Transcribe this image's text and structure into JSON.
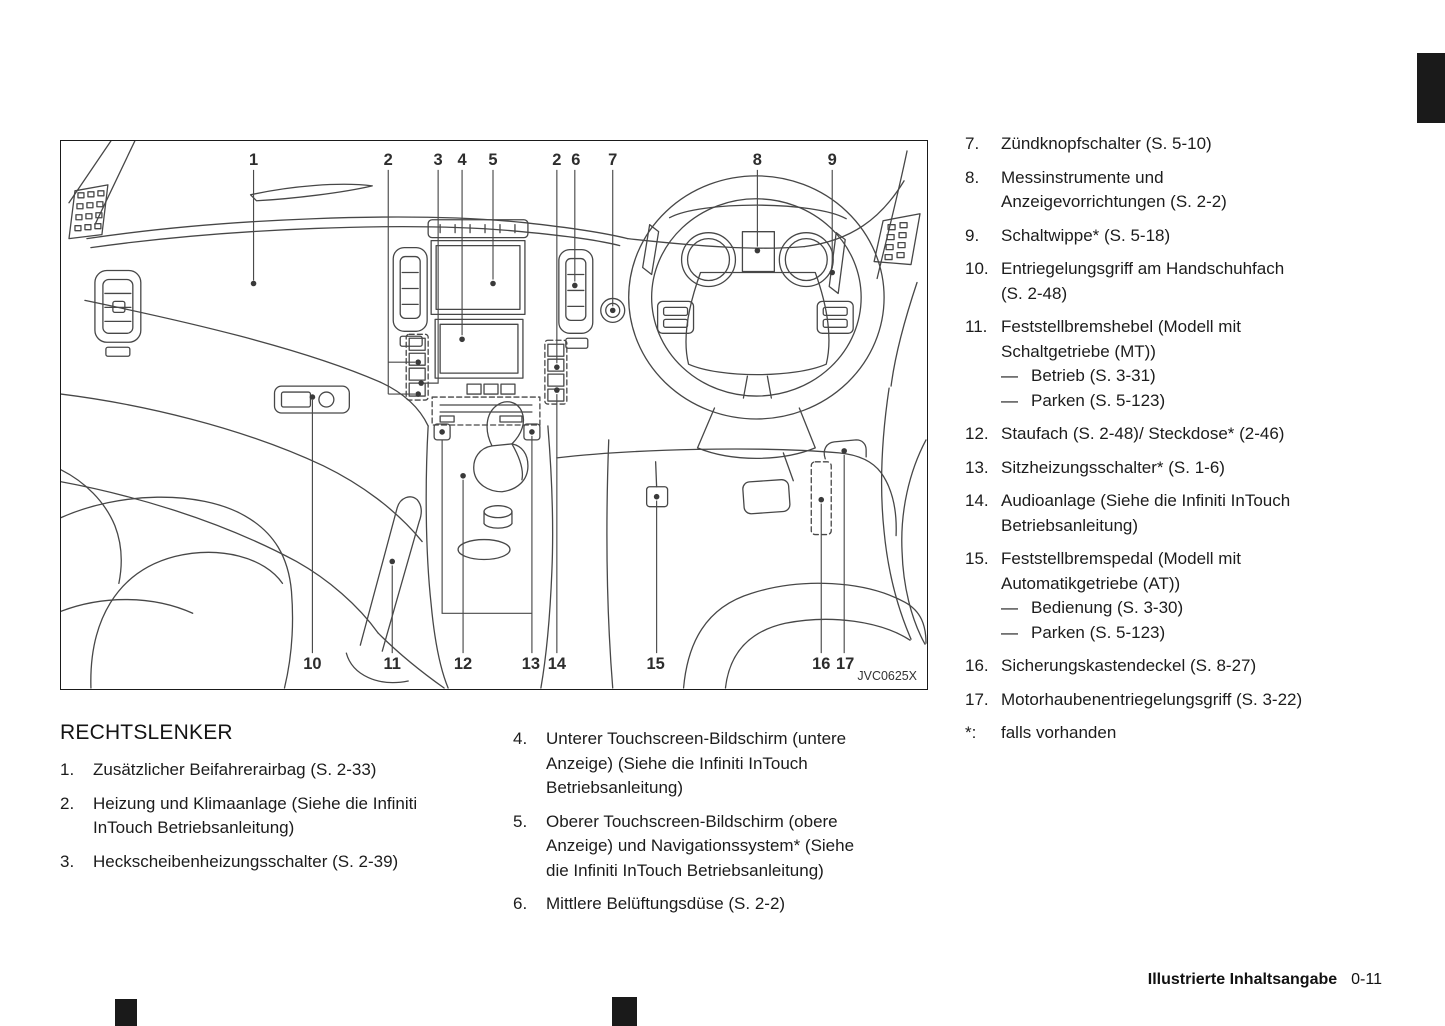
{
  "colors": {
    "background": "#ffffff",
    "ink": "#1c1c1c",
    "diagram_line": "#474747",
    "tab_marker": "#1a1a1a"
  },
  "figure": {
    "code": "JVC0625X",
    "callouts_top": [
      "1",
      "2",
      "3",
      "4",
      "5",
      "2",
      "6",
      "7",
      "8",
      "9"
    ],
    "callouts_bottom": [
      "10",
      "11",
      "12",
      "13",
      "14",
      "15",
      "16",
      "17"
    ]
  },
  "legend": {
    "heading": "RECHTSLENKER",
    "dash": "—",
    "col1": [
      {
        "num": "1.",
        "lines": [
          "Zusätzlicher Beifahrerairbag (S. 2-33)"
        ]
      },
      {
        "num": "2.",
        "lines": [
          "Heizung und Klimaanlage (Siehe die Infiniti",
          "InTouch Betriebsanleitung)"
        ]
      },
      {
        "num": "3.",
        "lines": [
          "Heckscheibenheizungsschalter (S. 2-39)"
        ]
      }
    ],
    "col2": [
      {
        "num": "4.",
        "lines": [
          "Unterer Touchscreen-Bildschirm (untere",
          "Anzeige) (Siehe die Infiniti InTouch",
          "Betriebsanleitung)"
        ]
      },
      {
        "num": "5.",
        "lines": [
          "Oberer Touchscreen-Bildschirm (obere",
          "Anzeige) und Navigationssystem* (Siehe",
          "die Infiniti InTouch Betriebsanleitung)"
        ]
      },
      {
        "num": "6.",
        "lines": [
          "Mittlere Belüftungsdüse (S. 2-2)"
        ]
      }
    ],
    "col3": [
      {
        "num": "7.",
        "lines": [
          "Zündknopfschalter (S. 5-10)"
        ]
      },
      {
        "num": "8.",
        "lines": [
          "Messinstrumente und",
          "Anzeigevorrichtungen (S. 2-2)"
        ]
      },
      {
        "num": "9.",
        "lines": [
          "Schaltwippe* (S. 5-18)"
        ]
      },
      {
        "num": "10.",
        "lines": [
          "Entriegelungsgriff am Handschuhfach",
          "(S. 2-48)"
        ]
      },
      {
        "num": "11.",
        "lines": [
          "Feststellbremshebel (Modell mit",
          "Schaltgetriebe (MT))"
        ],
        "subs": [
          "Betrieb (S. 3-31)",
          "Parken (S. 5-123)"
        ]
      },
      {
        "num": "12.",
        "lines": [
          "Staufach (S. 2-48)/ Steckdose* (2-46)"
        ]
      },
      {
        "num": "13.",
        "lines": [
          "Sitzheizungsschalter* (S. 1-6)"
        ]
      },
      {
        "num": "14.",
        "lines": [
          "Audioanlage (Siehe die Infiniti InTouch",
          "Betriebsanleitung)"
        ]
      },
      {
        "num": "15.",
        "lines": [
          "Feststellbremspedal (Modell mit",
          "Automatikgetriebe (AT))"
        ],
        "subs": [
          "Bedienung (S. 3-30)",
          "Parken (S. 5-123)"
        ]
      },
      {
        "num": "16.",
        "lines": [
          "Sicherungskastendeckel (S. 8-27)"
        ]
      },
      {
        "num": "17.",
        "lines": [
          "Motorhaubenentriegelungsgriff (S. 3-22)"
        ]
      }
    ],
    "star": {
      "num": "*:",
      "text": "falls vorhanden"
    }
  },
  "footer": {
    "section": "Illustrierte Inhaltsangabe",
    "page": "0-11"
  }
}
